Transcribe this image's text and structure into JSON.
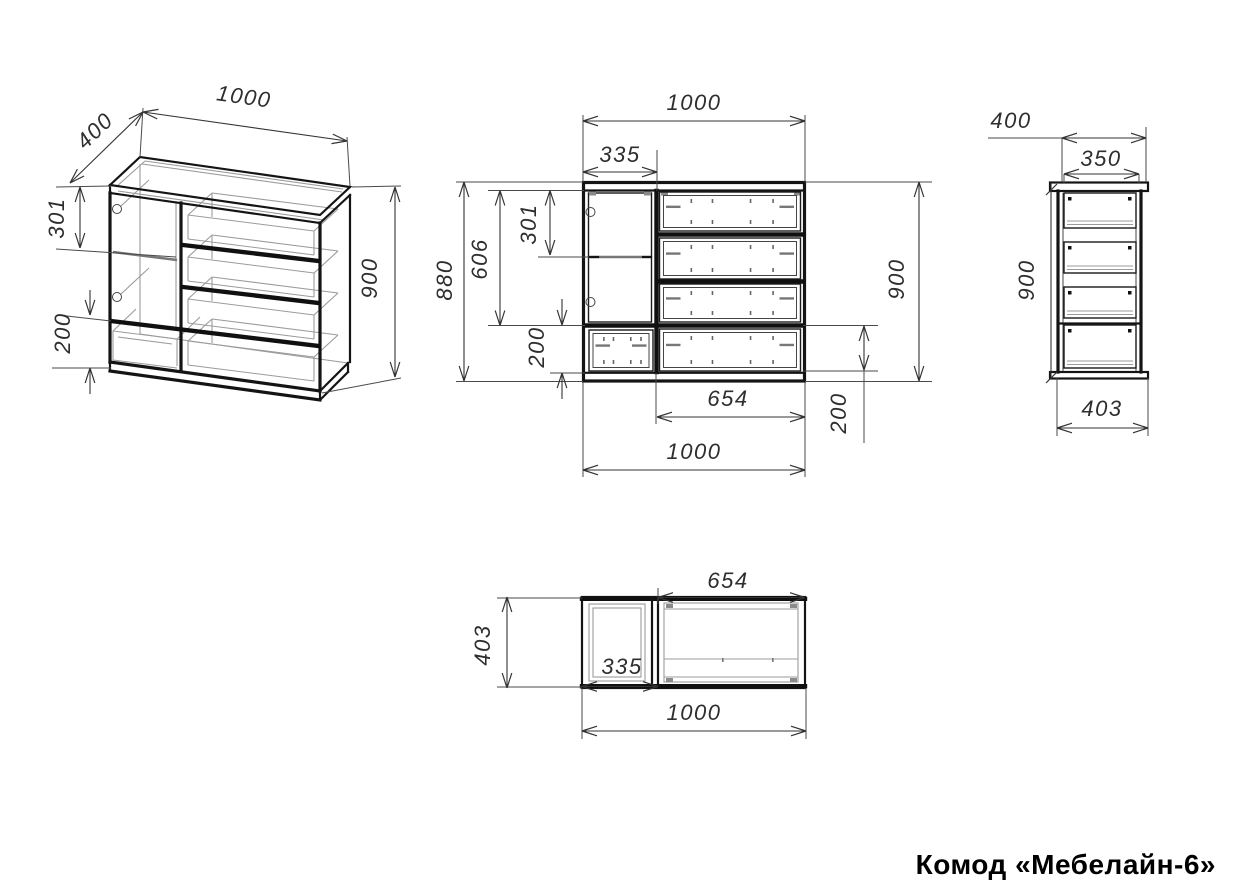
{
  "title": "Комод «Мебелайн-6»",
  "dimensions": {
    "iso": {
      "depth": "400",
      "width": "1000",
      "door_h": "301",
      "drawer_h": "200",
      "height": "900"
    },
    "front": {
      "width": "1000",
      "door_w": "335",
      "h_total": "880",
      "h_inner": "606",
      "door_h": "301",
      "drawer_h_left": "200",
      "height": "900",
      "drawers_w": "654",
      "drawer_h_right": "200",
      "width_bottom": "1000"
    },
    "side": {
      "depth": "400",
      "depth_top": "350",
      "height": "900",
      "depth_bottom": "403"
    },
    "top": {
      "drawers_w": "654",
      "depth": "403",
      "door_w": "335",
      "width": "1000"
    }
  }
}
